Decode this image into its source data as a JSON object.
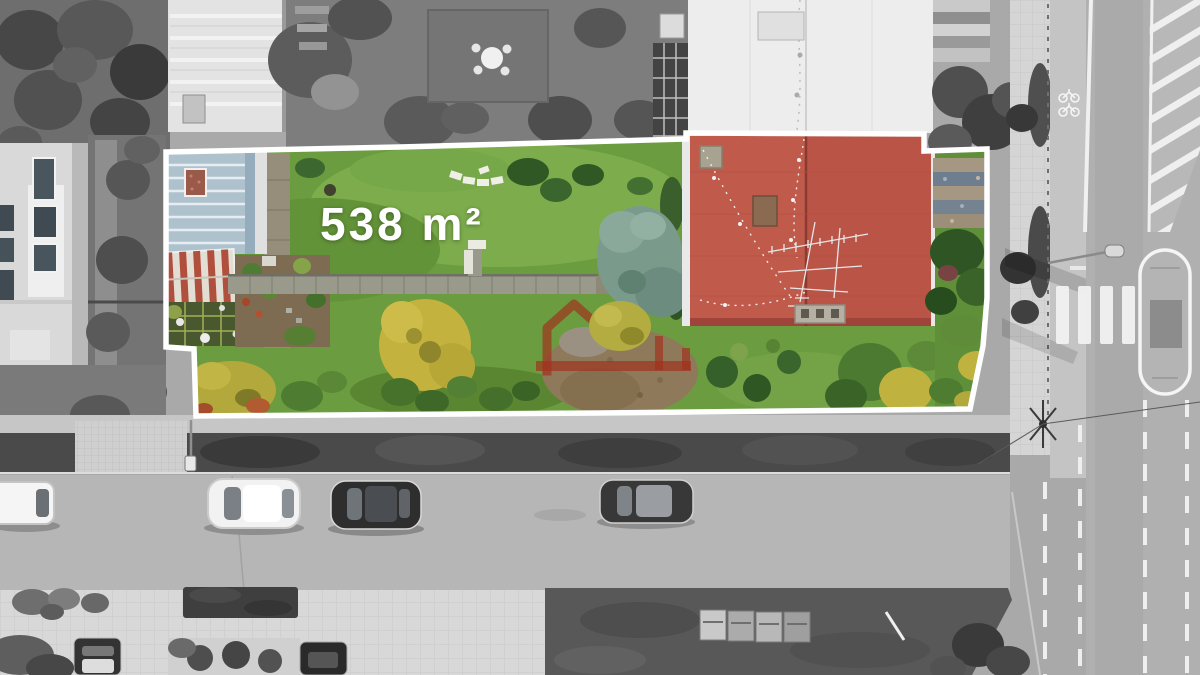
{
  "plot": {
    "area_label": "538 m²"
  },
  "colors": {
    "boundary_white": "#ffffff",
    "label_white": "#ffffff",
    "grass_green": "#6b9d40",
    "roof_red": "#c05a4b",
    "roof_blue_gray": "#aec2ce",
    "watermark_red": "#a1301c",
    "road_gray": "#b6b6b6"
  },
  "icons": {
    "watermark": "house-outline-logo-icon",
    "bike_lane_marking": "bicycle-icon",
    "crosswalk_marking": "zebra-stripes",
    "street_lamp": "lamp-icon"
  }
}
